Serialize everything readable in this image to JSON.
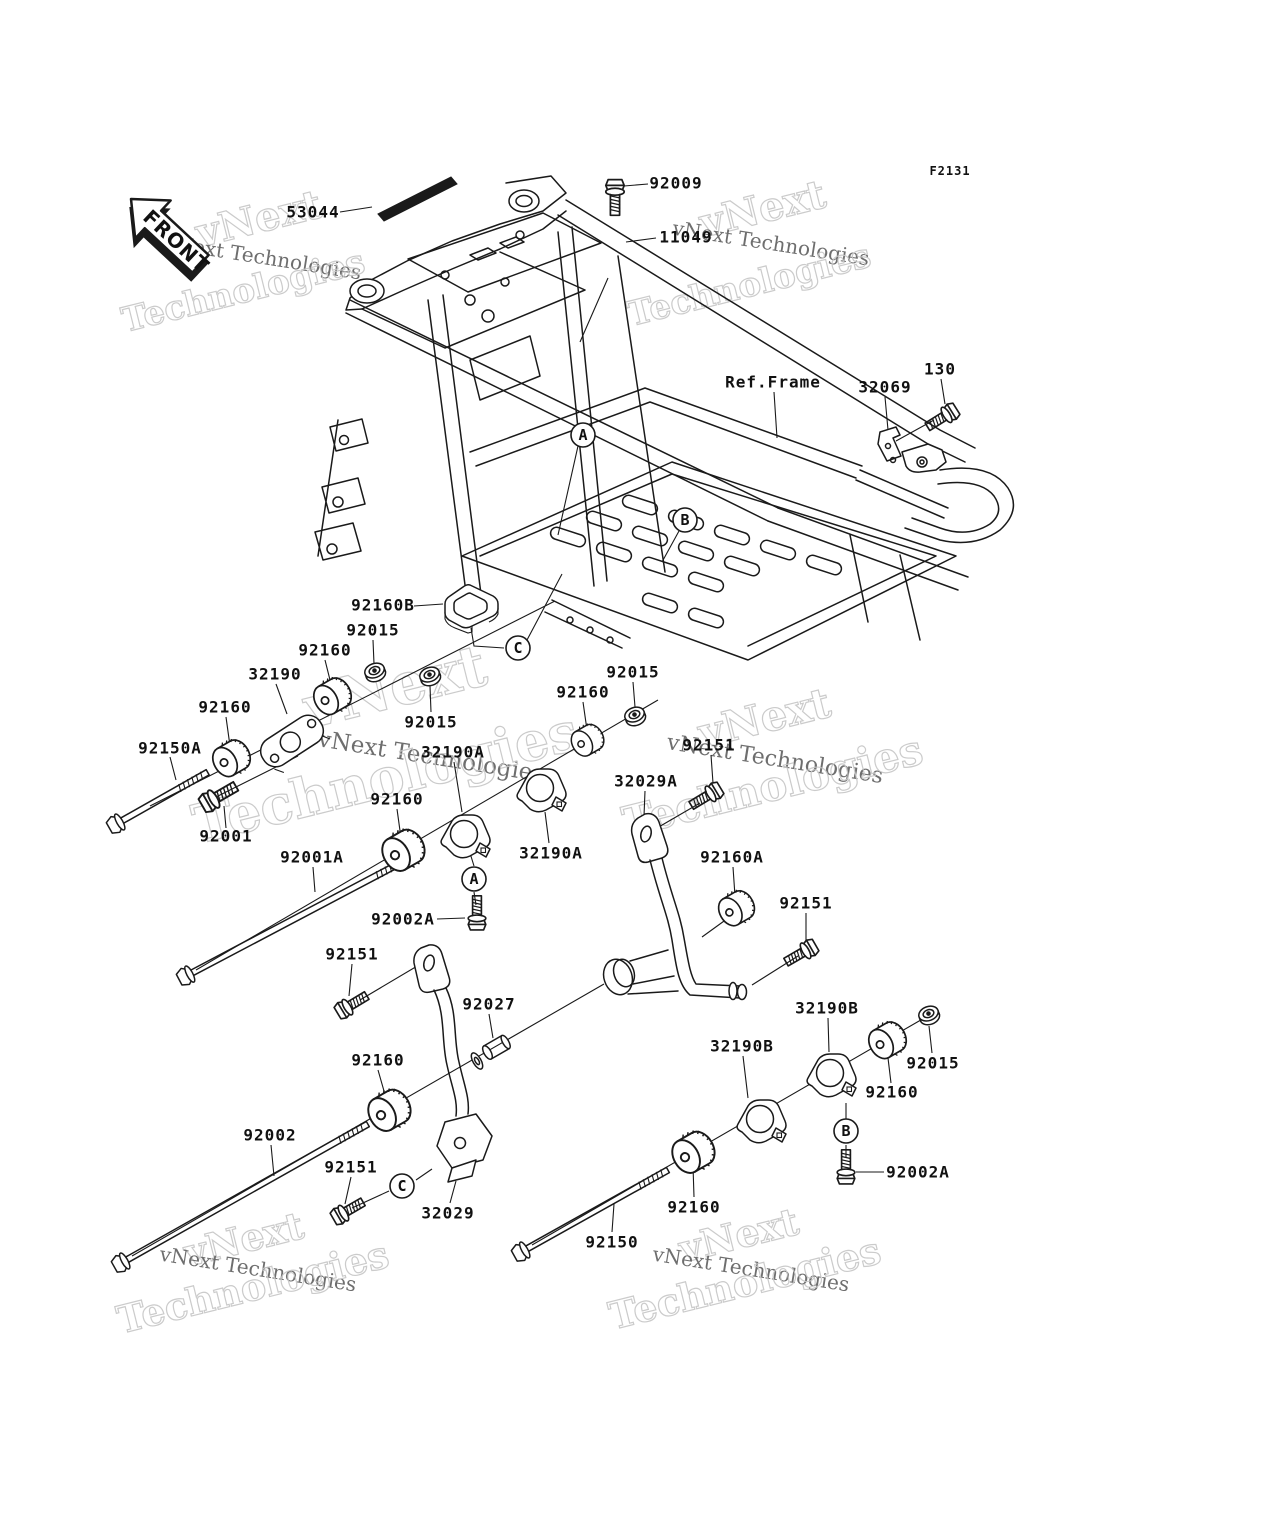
{
  "figure": {
    "code": "F2131"
  },
  "front_marker": {
    "label": "FRONT"
  },
  "frame_ref": {
    "label": "Ref.Frame"
  },
  "watermark": {
    "word1": "vNext",
    "word2": "Technologies",
    "combined": "vNext Technologies"
  },
  "callouts": [
    {
      "letter": "A"
    },
    {
      "letter": "B"
    },
    {
      "letter": "C"
    },
    {
      "letter": "A"
    },
    {
      "letter": "B"
    },
    {
      "letter": "C"
    }
  ],
  "part_labels": [
    {
      "text": "53044"
    },
    {
      "text": "92009"
    },
    {
      "text": "11049"
    },
    {
      "text": "32069"
    },
    {
      "text": "130"
    },
    {
      "text": "92160B"
    },
    {
      "text": "92015"
    },
    {
      "text": "92160"
    },
    {
      "text": "32190"
    },
    {
      "text": "92160"
    },
    {
      "text": "92150A"
    },
    {
      "text": "92015"
    },
    {
      "text": "92001"
    },
    {
      "text": "92001A"
    },
    {
      "text": "92160"
    },
    {
      "text": "32190A"
    },
    {
      "text": "32190A"
    },
    {
      "text": "92002A"
    },
    {
      "text": "92160"
    },
    {
      "text": "92015"
    },
    {
      "text": "92151"
    },
    {
      "text": "32029A"
    },
    {
      "text": "92160A"
    },
    {
      "text": "92151"
    },
    {
      "text": "92151"
    },
    {
      "text": "92027"
    },
    {
      "text": "92160"
    },
    {
      "text": "92002"
    },
    {
      "text": "92151"
    },
    {
      "text": "32029"
    },
    {
      "text": "32190B"
    },
    {
      "text": "32190B"
    },
    {
      "text": "92015"
    },
    {
      "text": "92160"
    },
    {
      "text": "92002A"
    },
    {
      "text": "92160"
    },
    {
      "text": "92150"
    }
  ]
}
